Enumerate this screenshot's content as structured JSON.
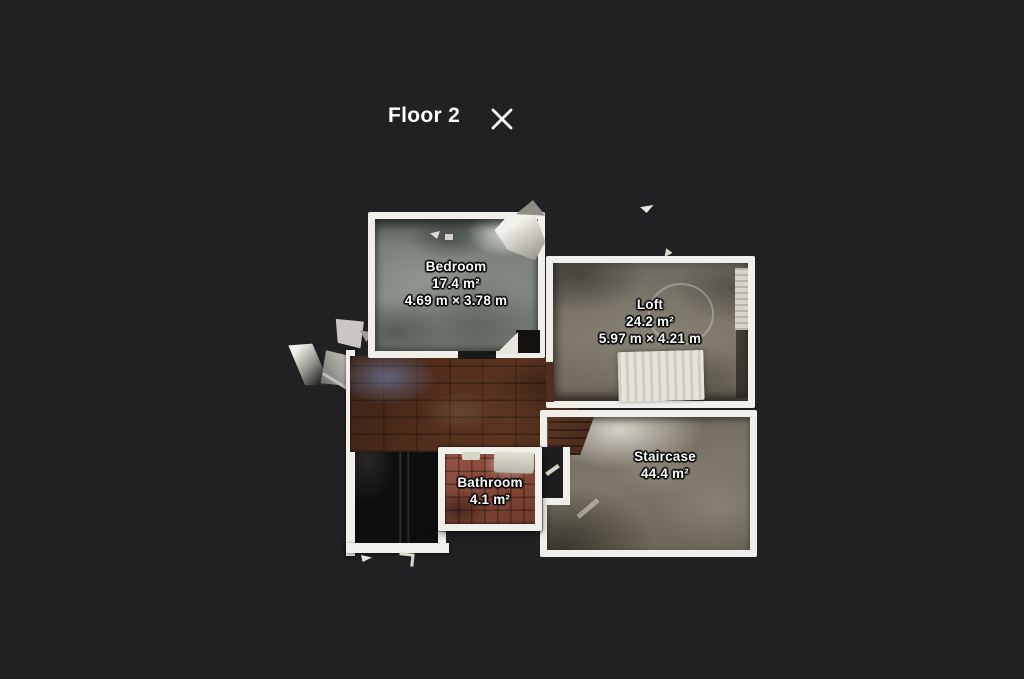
{
  "header": {
    "title": "Floor 2"
  },
  "rooms": {
    "bedroom": {
      "name": "Bedroom",
      "area": "17.4 m²",
      "dimensions": "4.69 m × 3.78 m"
    },
    "loft": {
      "name": "Loft",
      "area": "24.2 m²",
      "dimensions": "5.97 m × 4.21 m"
    },
    "bathroom": {
      "name": "Bathroom",
      "area": "4.1 m²"
    },
    "staircase": {
      "name": "Staircase",
      "area": "44.4 m²"
    }
  },
  "icons": {
    "close": "close-icon"
  },
  "colors": {
    "background": "#212123",
    "wall": "#f1efe9",
    "text": "#ffffff",
    "bedroom_floor": "#7d847d",
    "loft_floor": "#7a756a",
    "hall_floor": "#4e2e1d",
    "bathroom_floor": "#8a4c3a",
    "staircase_floor": "#7c7768",
    "dark_unscanned": "#0e0e0f"
  }
}
